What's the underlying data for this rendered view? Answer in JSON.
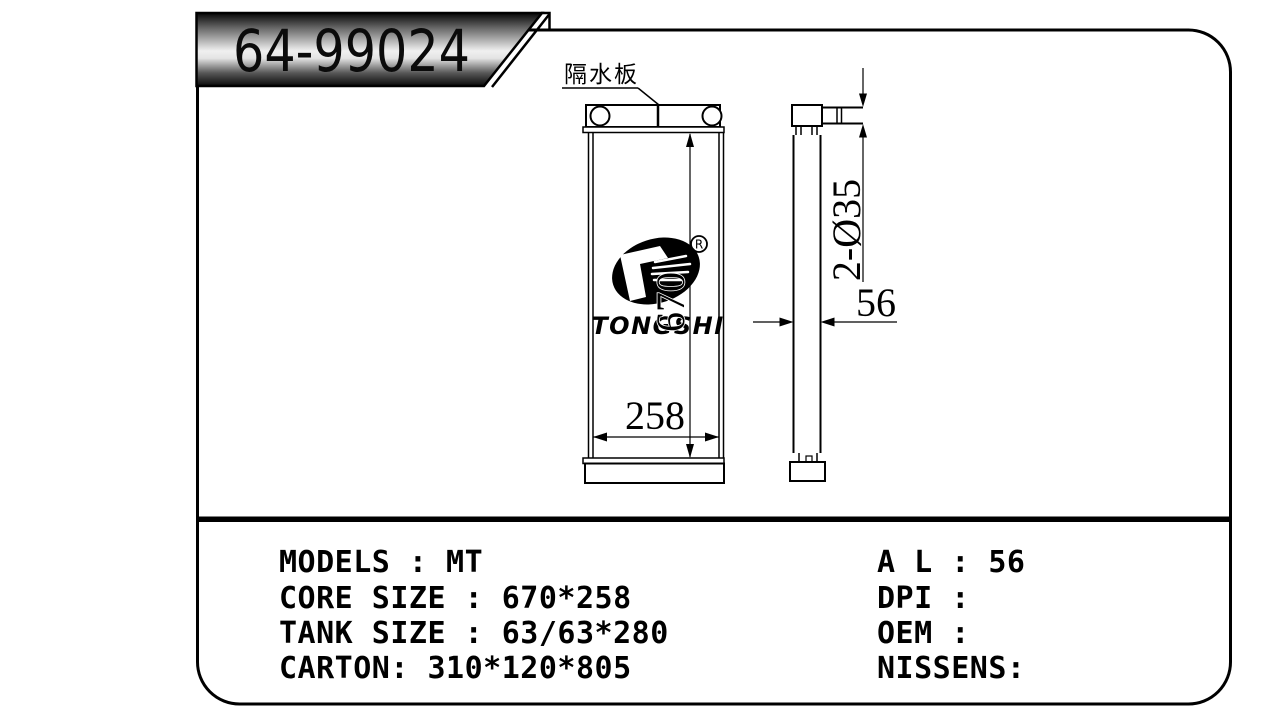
{
  "banner": {
    "part_number": "64-99024"
  },
  "drawing": {
    "separator_label": "隔水板",
    "height_dim": "670",
    "width_dim": "258",
    "depth_dim": "56",
    "pipe_dim": "2-Ø35",
    "logo": {
      "text": "TONGSHI",
      "registered": "R"
    }
  },
  "specs": {
    "left": [
      "MODELS : MT",
      "CORE SIZE : 670*258",
      "TANK SIZE : 63/63*280",
      "CARTON: 310*120*805"
    ],
    "right": [
      "A L : 56",
      "DPI :",
      "OEM :",
      "NISSENS:"
    ]
  },
  "colors": {
    "line": "#000000",
    "background": "#ffffff",
    "banner_dark": "#0a0a0a",
    "banner_light": "#f0f0f0"
  }
}
